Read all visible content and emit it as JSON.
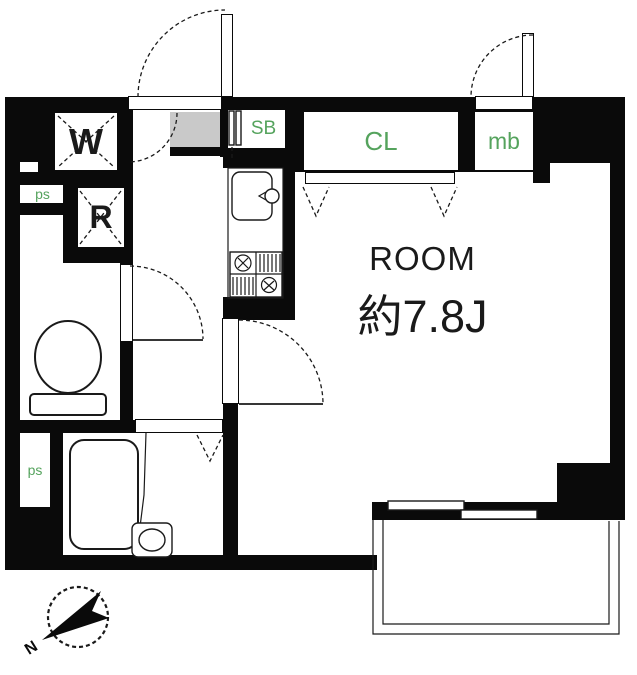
{
  "floor_plan": {
    "room": {
      "name": "ROOM",
      "size_label": "約7.8J"
    },
    "labels": {
      "washer": "W",
      "refrigerator": "R",
      "shoe_box": "SB",
      "closet": "CL",
      "meter_box": "mb",
      "pipe_space_top": "ps",
      "pipe_space_bottom": "ps"
    },
    "compass": {
      "north_label": "N"
    },
    "colors": {
      "wall": "#0a0a0a",
      "label_green": "#55a35d",
      "entry_floor_gray": "#c9c9c9",
      "line": "#1a1a1a",
      "background": "#ffffff"
    }
  }
}
